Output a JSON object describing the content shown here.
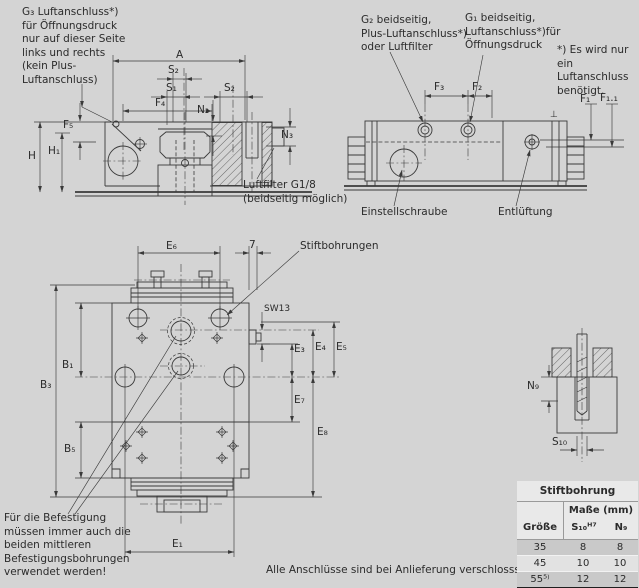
{
  "colors": {
    "background": "#d4d4d4",
    "line": "#3a3a3a",
    "table_header_bg": "#e9e9e9",
    "table_row_dark": "#c9c9c9",
    "table_row_light": "#e2e2e2",
    "table_bottom_border": "#1f1f1f"
  },
  "notes": {
    "g3_callout": "G₃ Luftanschluss*)\nfür Öffnungsdruck\nnur auf dieser Seite\nlinks und rechts\n(kein Plus-\nLuftanschluss)",
    "g2_callout": "G₂ beidseitig,\nPlus-Luftanschluss*)\noder Luftfilter",
    "g1_callout": "G₁ beidseitig,\nLuftanschluss*)für\nÖffnungsdruck",
    "air_footnote": "*) Es wird nur\nein Luftanschluss\nbenötigt.",
    "luftfilter": "Luftfilter G1/8\n(beidseitig möglich)",
    "einstellschraube": "Einstellschraube",
    "entlueftung": "Entlüftung",
    "stiftbohrungen": "Stiftbohrungen",
    "befestigung_note": "Für die Befestigung\nmüssen immer auch die\nbeiden mittleren\nBefestigungsbohrungen\nverwendet werden!",
    "delivery_note": "Alle Anschlüsse sind bei Anlieferung verschlosssen.",
    "perpendicularity_symbol": "⊥"
  },
  "dim_labels": {
    "a": "A",
    "s1": "S₁",
    "s2": "S₂",
    "f4": "F₄",
    "f5": "F₅",
    "n2": "N₂",
    "n3": "N₃",
    "h": "H",
    "h1": "H₁",
    "f3": "F₃",
    "f2": "F₂",
    "f1": "F₁",
    "f1_1": "F₁.₁",
    "e1": "E₁",
    "e3": "E₃",
    "e4": "E₄",
    "e5": "E₅",
    "e6": "E₆",
    "e7": "E₇",
    "e8": "E₈",
    "b1": "B₁",
    "b3": "B₃",
    "b5": "B₅",
    "seven": "7",
    "sw13": "SW13",
    "n9": "N₉",
    "s10": "S₁₀"
  },
  "table": {
    "title": "Stiftbohrung",
    "subtitle": "Maße (mm)",
    "columns": [
      "Größe",
      "S₁₀ᴴ⁷",
      "N₉"
    ],
    "rows": [
      [
        "35",
        "8",
        "8"
      ],
      [
        "45",
        "10",
        "10"
      ],
      [
        "55⁵⁾",
        "12",
        "12"
      ]
    ]
  }
}
